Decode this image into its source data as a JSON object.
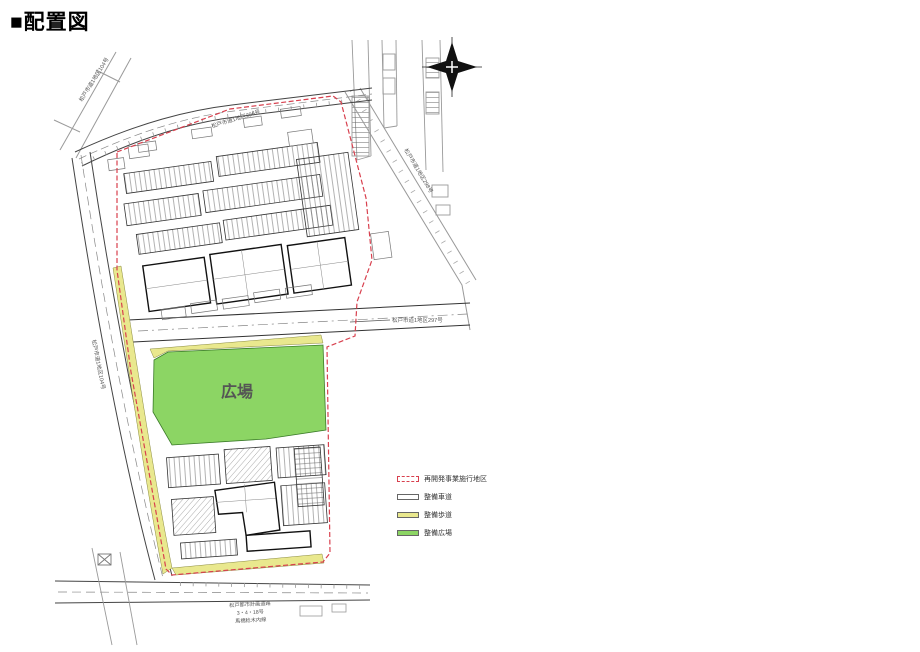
{
  "page": {
    "title": "■配置図"
  },
  "drawing": {
    "plaza_label": "広場",
    "roads": {
      "top_left": "松戸市道1地区104号",
      "top": "松戸市道1地区296号",
      "left": "松戸市道1地区104号",
      "middle": "松戸市道1地区297号",
      "right": "松戸市道1地区298号",
      "bottom_line1": "松戸都市計画道路",
      "bottom_line2": "3・4・18号",
      "bottom_line3": "馬橋稔木内線"
    },
    "legend": {
      "items": [
        {
          "label": "再開発事業施行地区",
          "swatch": "red-dashed-outline",
          "color": "#d8404e"
        },
        {
          "label": "整備車道",
          "swatch": "white-outline",
          "color": "#ffffff"
        },
        {
          "label": "整備歩道",
          "swatch": "yellow-fill",
          "color": "#e9e88e"
        },
        {
          "label": "整備広場",
          "swatch": "green-fill",
          "color": "#8cd564"
        }
      ]
    },
    "colors": {
      "boundary_red": "#d8404e",
      "plaza_green": "#8cd564",
      "sidewalk_yellow": "#e9e88e",
      "line_dark": "#333333",
      "line_gray": "#999999"
    }
  }
}
